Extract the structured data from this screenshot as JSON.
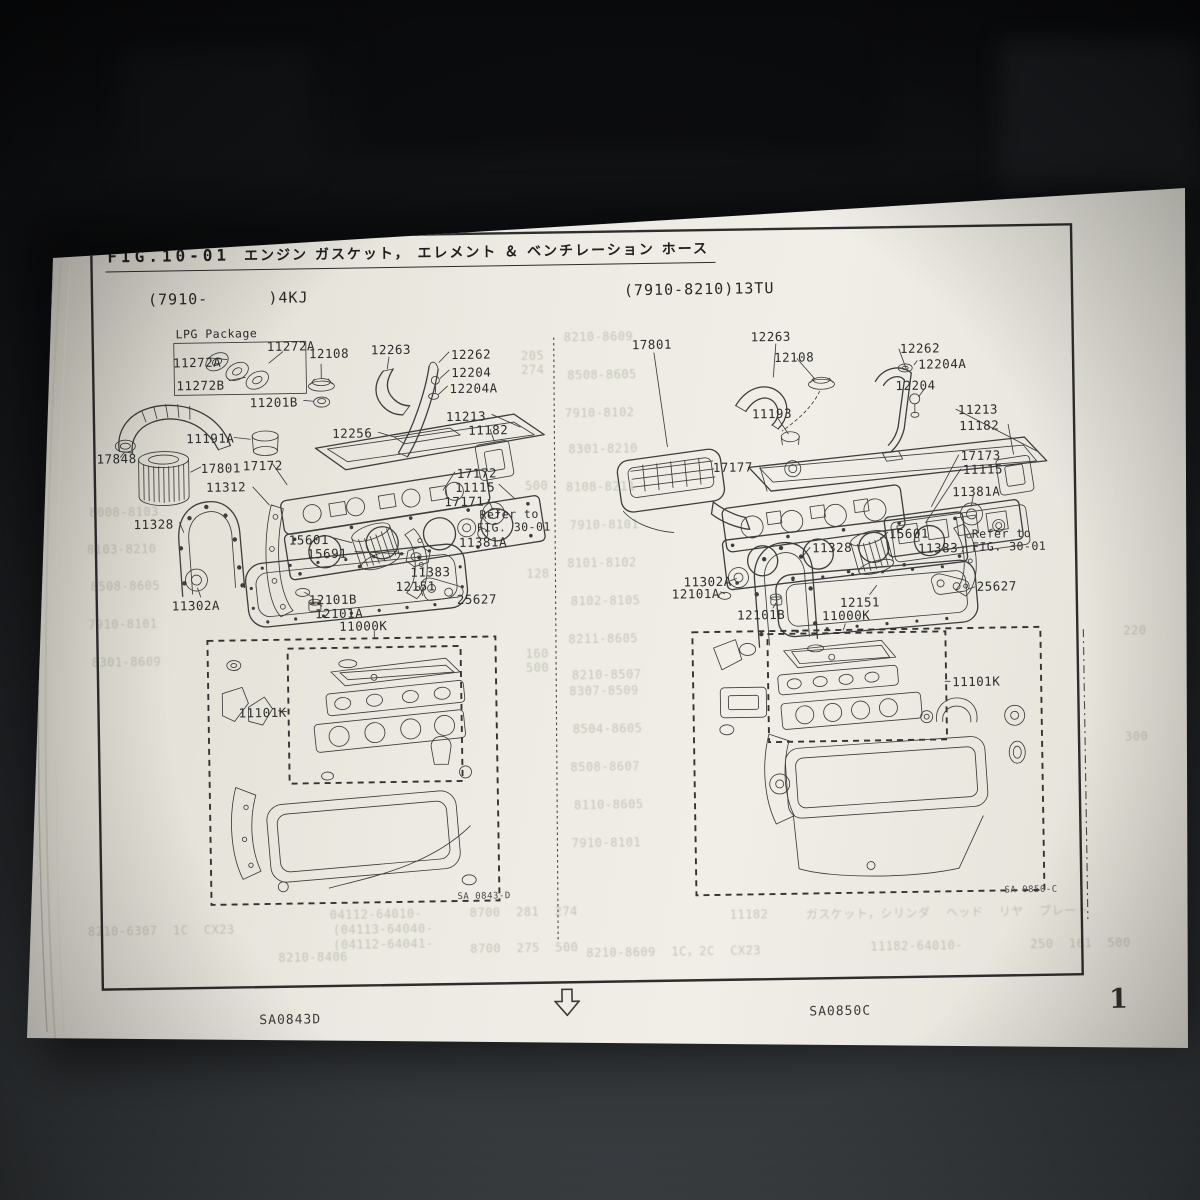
{
  "page": {
    "doc_code": "CK1-20-0661",
    "title": {
      "fig": "FIG.10-01",
      "caption": "エンジン ガスケット， エレメント ＆ ベンチレーション ホース"
    },
    "left_diagram": {
      "header": "(7910-      )4KJ",
      "lpg_box_label": "LPG Package",
      "plate_code": "SA 0843-D",
      "labels": [
        "11272A",
        "11272A",
        "12108",
        "12263",
        "12262",
        "12204",
        "12204A",
        "11272B",
        "11201B",
        "11213",
        "11182",
        "11191A",
        "12256",
        "17848",
        "17801",
        "17172",
        "17172",
        "11312",
        "11115",
        "17171",
        "11328",
        "Refer to",
        "FIG. 30-01",
        "11381A",
        "15601",
        "15691",
        "11383",
        "12151",
        "11302A",
        "12101B",
        "12101A",
        "25627",
        "11000K",
        "11101K"
      ]
    },
    "right_diagram": {
      "header": "(7910-8210)13TU",
      "plate_code": "SA 0850-C",
      "labels": [
        "17801",
        "12263",
        "12108",
        "12262",
        "12204A",
        "12204",
        "11193",
        "11213",
        "11182",
        "17177",
        "17173",
        "11115",
        "11381A",
        "15601",
        "11328",
        "11383",
        "Refer to",
        "FIG. 30-01",
        "11302A",
        "12101A",
        "12151",
        "25627",
        "12101B",
        "11000K",
        "11101K"
      ]
    },
    "footer": {
      "left_code": "SA0843D",
      "right_code": "SA0850C",
      "page_number": "1"
    },
    "ghost_text": [
      "8210-8609",
      "8508-8605",
      "7910-8102",
      "8301-8210",
      "8108-8211",
      "7910-8101",
      "8101-8102",
      "8102-8105",
      "8211-8605",
      "8210-8507",
      "8307-8509",
      "8504-8605",
      "8508-8607",
      "8110-8605",
      "7910-8101",
      "205",
      "274",
      "500",
      "128",
      "160",
      "500",
      "220",
      "300",
      "8008-8103",
      "8103-8210",
      "8508-8605",
      "7910-8101",
      "8301-8609",
      "04112-64010-",
      "(04113-64040-",
      "(04112-64041-",
      "8700  281  274",
      "8700  275  500",
      "8210-8406",
      "8210-6307  1C  CX23",
      "11182",
      "ガスケット，シリンダ  ヘッド  リヤ  プレート",
      "8210-8609  1C，2C  CX23",
      "11182-64010-",
      "250  161  500"
    ]
  }
}
